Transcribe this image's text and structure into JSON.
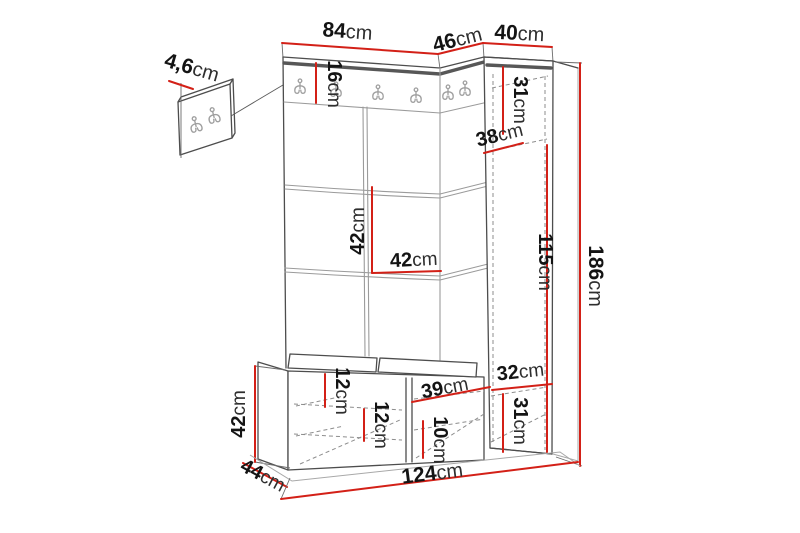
{
  "diagram": {
    "kind": "furniture-dimension-drawing",
    "unit_suffix": "cm",
    "hooks_on_rail": 6,
    "hooks_on_detail_panel": 2,
    "colors": {
      "dimension_line": "#d32017",
      "outline": "#4d4d4d",
      "seam": "#9b9b9b",
      "hook": "#9f9f9f",
      "text": "#181818",
      "background": "#ffffff"
    },
    "icons": {
      "hook": "double-coat-hook-icon"
    }
  },
  "labels": {
    "detail_panel_thickness": "4,6cm",
    "panel_width": "84cm",
    "cabinet_side_depth": "46cm",
    "cabinet_width": "40cm",
    "hook_rail_height": "16cm",
    "cabinet_top_section_height": "31cm",
    "cabinet_shelf_depth": "38cm",
    "panel_tile_height": "42cm",
    "panel_tile_width": "42cm",
    "cabinet_inner_height": "115cm",
    "total_height": "186cm",
    "bench_height": "42cm",
    "bench_depth": "44cm",
    "bench_shelf_spacing_upper": "12cm",
    "bench_shelf_spacing_lower": "12cm",
    "bench_compartment_width": "39cm",
    "bench_shelf_spacing_right": "10cm",
    "cabinet_bottom_shelf_width": "32cm",
    "cabinet_bottom_section_height": "31cm",
    "total_width": "124cm"
  }
}
